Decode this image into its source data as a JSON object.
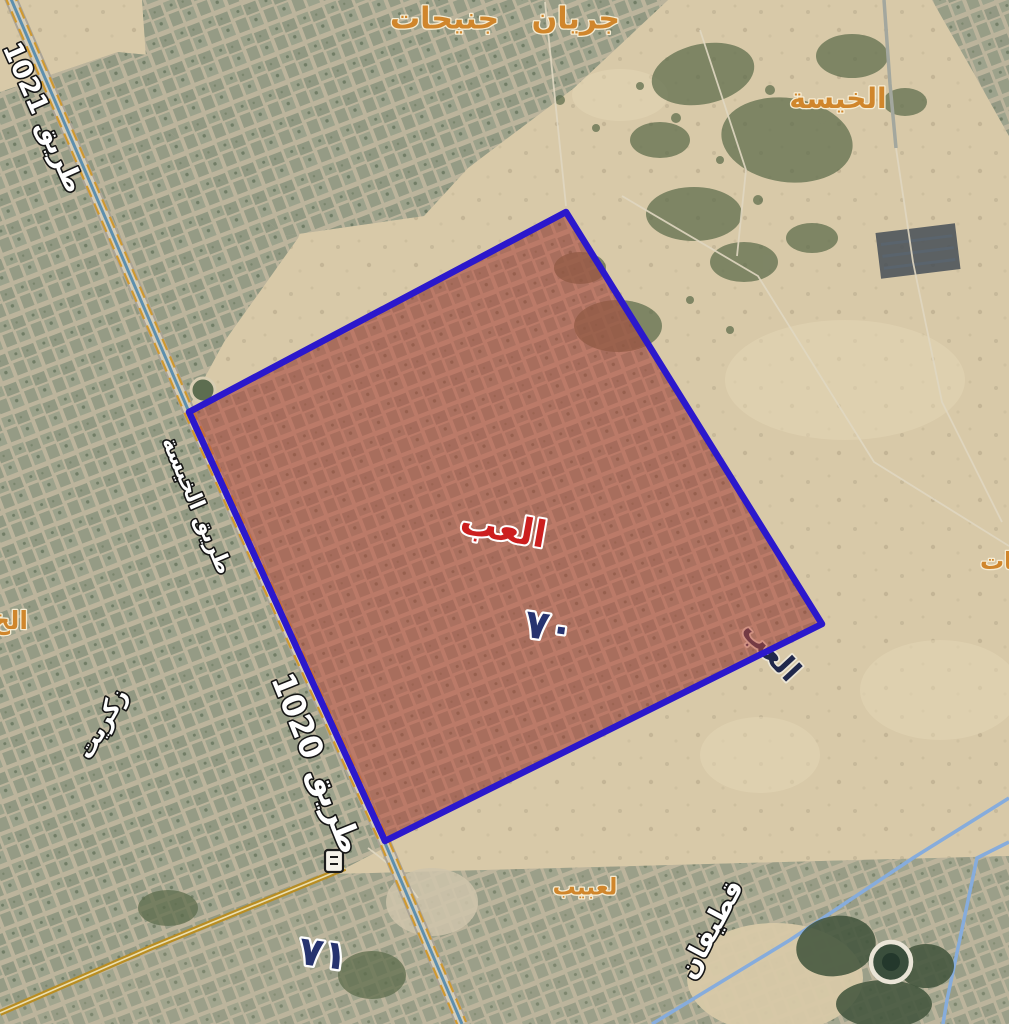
{
  "map": {
    "zone": {
      "name": "العب",
      "number": "٧٠",
      "hidden_duplicate_name": "العب",
      "fill_color": "#b94b3e",
      "border_color": "#2b18cc"
    },
    "adjacent_zone_number": "٧١",
    "area_labels": {
      "jeryan_jenaihat": "جريان جنيحات",
      "al_kheesa": "الخيسة",
      "leabaib": "لعبيب",
      "partial_right_edge": "نات",
      "partial_left_edge": "الخ"
    },
    "road_labels": {
      "route_1021": "طريق 1021",
      "al_khisah_road": "طريق الخيسة",
      "route_1020": "طريق 1020",
      "qatifan": "قطيفان",
      "zekreet": "زكريت"
    },
    "colors": {
      "district_label_text": "#d0862c",
      "road_label_text": "#ffffff",
      "zone_number_text": "#26336f",
      "zone_name_text": "#cc1f1f",
      "yellow_road": "#c9952b",
      "blue_road": "#86acdc"
    }
  }
}
